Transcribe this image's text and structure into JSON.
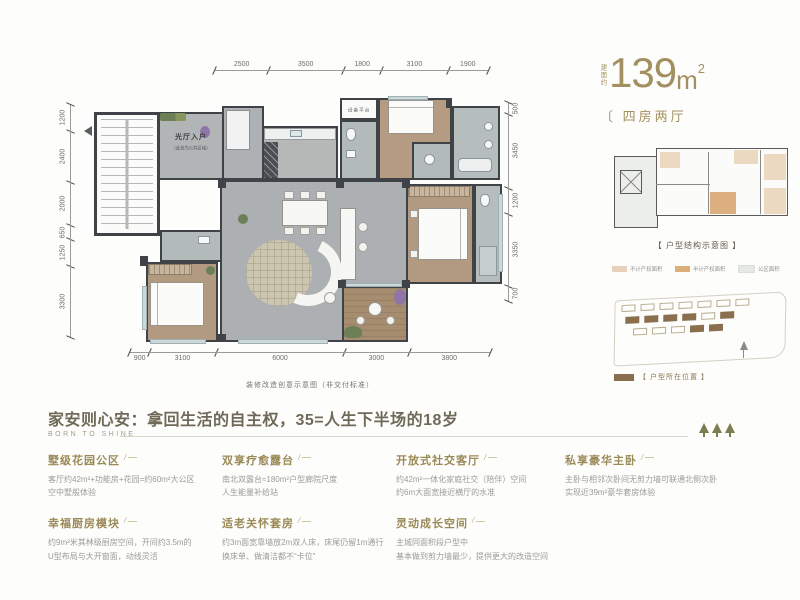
{
  "header": {
    "area_prefix": "建面约",
    "area_number": "139",
    "area_unit": "m",
    "area_sup": "2",
    "unit_type": "〔 四房两厅"
  },
  "floor_plan": {
    "entry_label": "光厅入户",
    "entry_note": "（此处为公共区域）",
    "equipment_label": "设备平台",
    "caption": "装修改造创意示意图（非交付标准）",
    "dims_top": [
      "2500",
      "3500",
      "1800",
      "3100",
      "1900"
    ],
    "dims_left": [
      "1200",
      "2400",
      "2000",
      "650",
      "1250",
      "3300"
    ],
    "dims_right": [
      "500",
      "3450",
      "1200",
      "3350",
      "700"
    ],
    "dims_bottom": [
      "900",
      "3100",
      "6000",
      "3000",
      "3800"
    ]
  },
  "structure": {
    "caption": "【 户型结构示意图 】",
    "legend": [
      {
        "label": "不计产权面积",
        "color": "#e6d2bc"
      },
      {
        "label": "半计产权面积",
        "color": "#ddad7c"
      },
      {
        "label": "公区面积",
        "color": "#e6e8e6"
      }
    ]
  },
  "site": {
    "caption": "【 户型所在位置 】",
    "highlight_color": "#8a6f4e"
  },
  "tagline": {
    "headline": "家安则心安：拿回生活的自主权，35=人生下半场的18岁",
    "subline": "BORN TO SHINE"
  },
  "features": [
    {
      "title": "墅级花园公区",
      "line1": "客厅约42m²+功能房+花园=约60m²大公区",
      "line2": "空中墅般体验"
    },
    {
      "title": "幸福厨房模块",
      "line1": "约9m²米其林级厨房空间，开间约3.5m的",
      "line2": "U型布局与大开窗面，动线灵活"
    },
    {
      "title": "双享疗愈露台",
      "line1": "南北双露台≈180m²户型廊院尺度",
      "line2": "人生能量补给站"
    },
    {
      "title": "适老关怀套房",
      "line1": "约3m面宽靠墙放2m双人床，床尾仍留1m通行",
      "line2": "换床单、做清洁都不“卡位”"
    },
    {
      "title": "开放式社交客厅",
      "line1": "约42m²一体化家庭社交（陪伴）空间",
      "line2": "约6m大面宽接近横厅的水准"
    },
    {
      "title": "灵动成长空间",
      "line1": "主城同面积段户型中",
      "line2": "基本做到剪力墙最少，提供更大的改造空间"
    },
    {
      "title": "私享豪华主卧",
      "line1": "主卧与相邻次卧间无剪力墙可联通北侧次卧",
      "line2": "实现近39m²豪华套房体验"
    }
  ]
}
